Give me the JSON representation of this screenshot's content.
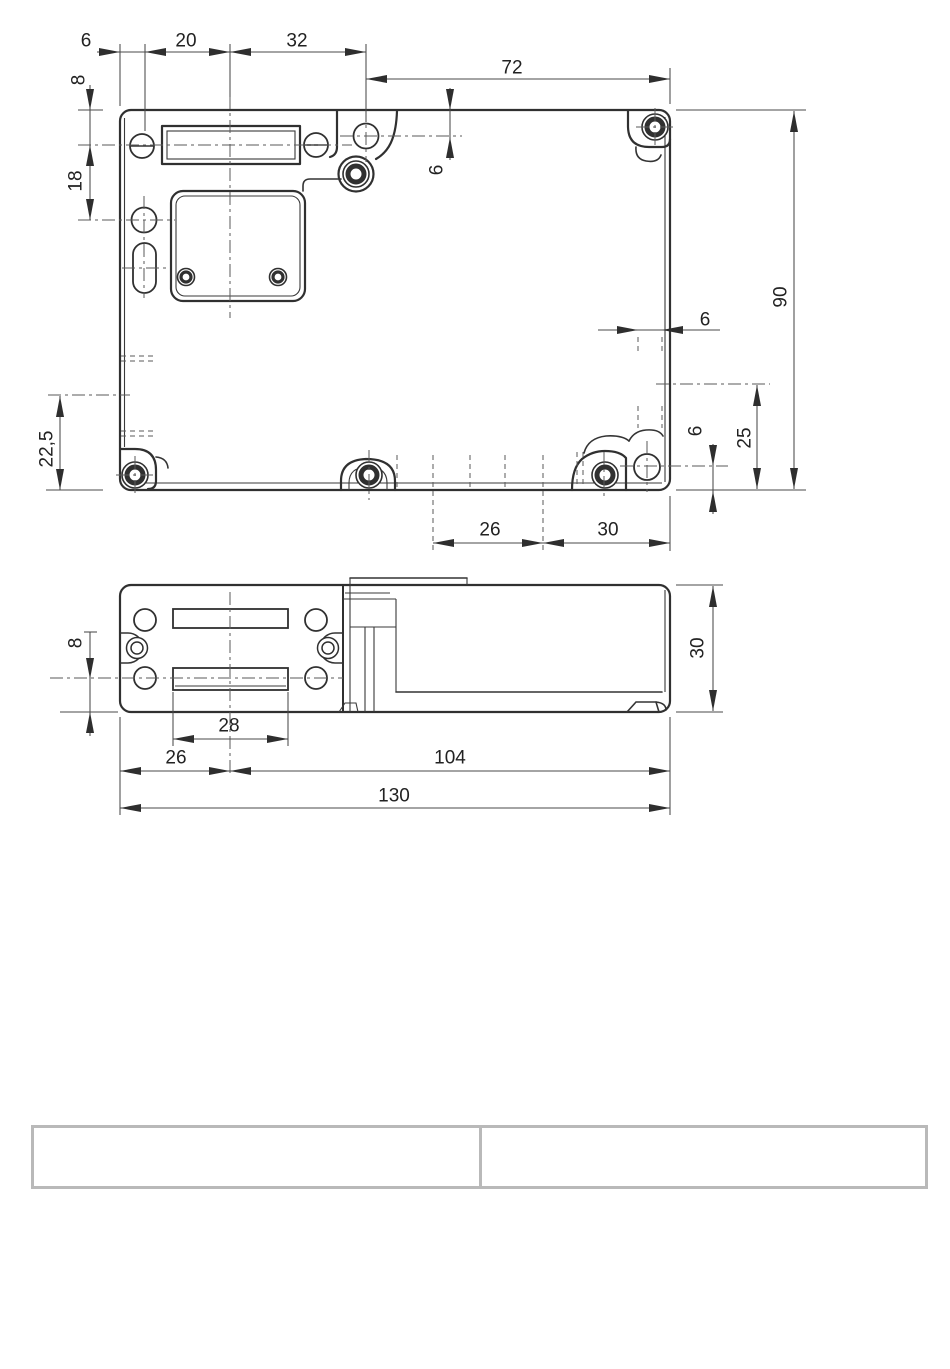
{
  "colors": {
    "background": "#ffffff",
    "drawing_line": "#303030",
    "dimension_line": "#4a4a4a",
    "text": "#222222",
    "table_border": "#b9b9b9"
  },
  "drawing": {
    "type": "technical-dimension-drawing",
    "views": {
      "top": "top-view-housing",
      "front": "side-view-housing"
    },
    "top_view": {
      "dims": {
        "d6_left": "6",
        "d20": "20",
        "d32": "32",
        "d72": "72",
        "d8": "8",
        "d18": "18",
        "d6_lug": "6",
        "d90": "90",
        "d6_slot": "6",
        "d25": "25",
        "d6_corner": "6",
        "d22_5": "22,5",
        "d26": "26",
        "d30": "30"
      }
    },
    "side_view": {
      "dims": {
        "s8": "8",
        "s28": "28",
        "s26": "26",
        "s104": "104",
        "s130": "130",
        "s30": "30"
      }
    }
  },
  "table": {
    "cells": [
      "",
      ""
    ]
  }
}
